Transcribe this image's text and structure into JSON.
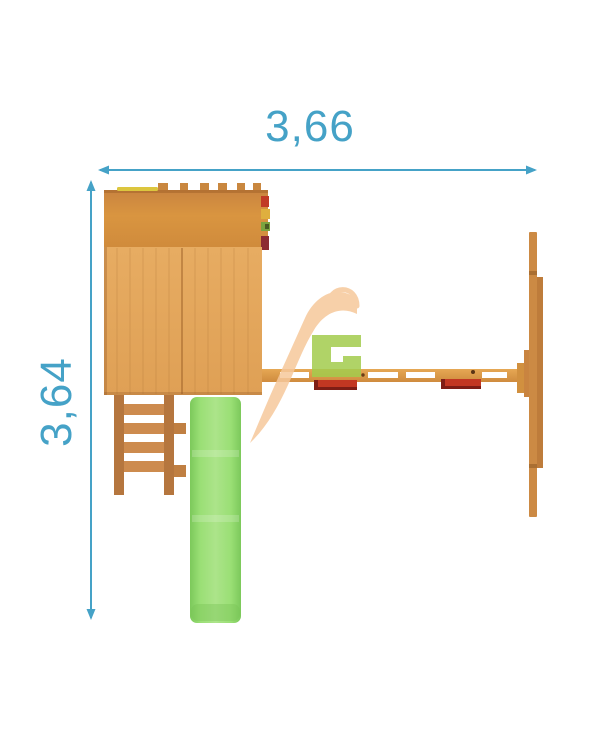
{
  "dimensions": {
    "width_label": "3,66",
    "height_label": "3,64"
  },
  "colors": {
    "dimension_blue": "#45a2c7",
    "wood_roof": "#cf8b3e",
    "wood_floor": "#e2a65c",
    "wood_beam": "#d9953f",
    "wood_ladder_rail": "#b5763e",
    "wood_ladder_rung": "#cd8b4e",
    "wood_support": "#cc8a44",
    "slide_green": "#8fd568",
    "slide_green_light": "#ace48a",
    "seat_red": "#c23722",
    "seat_red_dark": "#7e1d15",
    "accessory_red": "#c13a26",
    "accessory_yellow": "#dfaf3e",
    "accessory_green": "#7ca43f",
    "accessory_maroon": "#8c2b31",
    "roof_trim_yellow": "#dcc63e",
    "logo_orange": "#f6c89b",
    "logo_green": "#a3cc4d",
    "logo_green_light": "#c7df7b"
  },
  "icons": {
    "watermark": "brand-logo-sg"
  }
}
